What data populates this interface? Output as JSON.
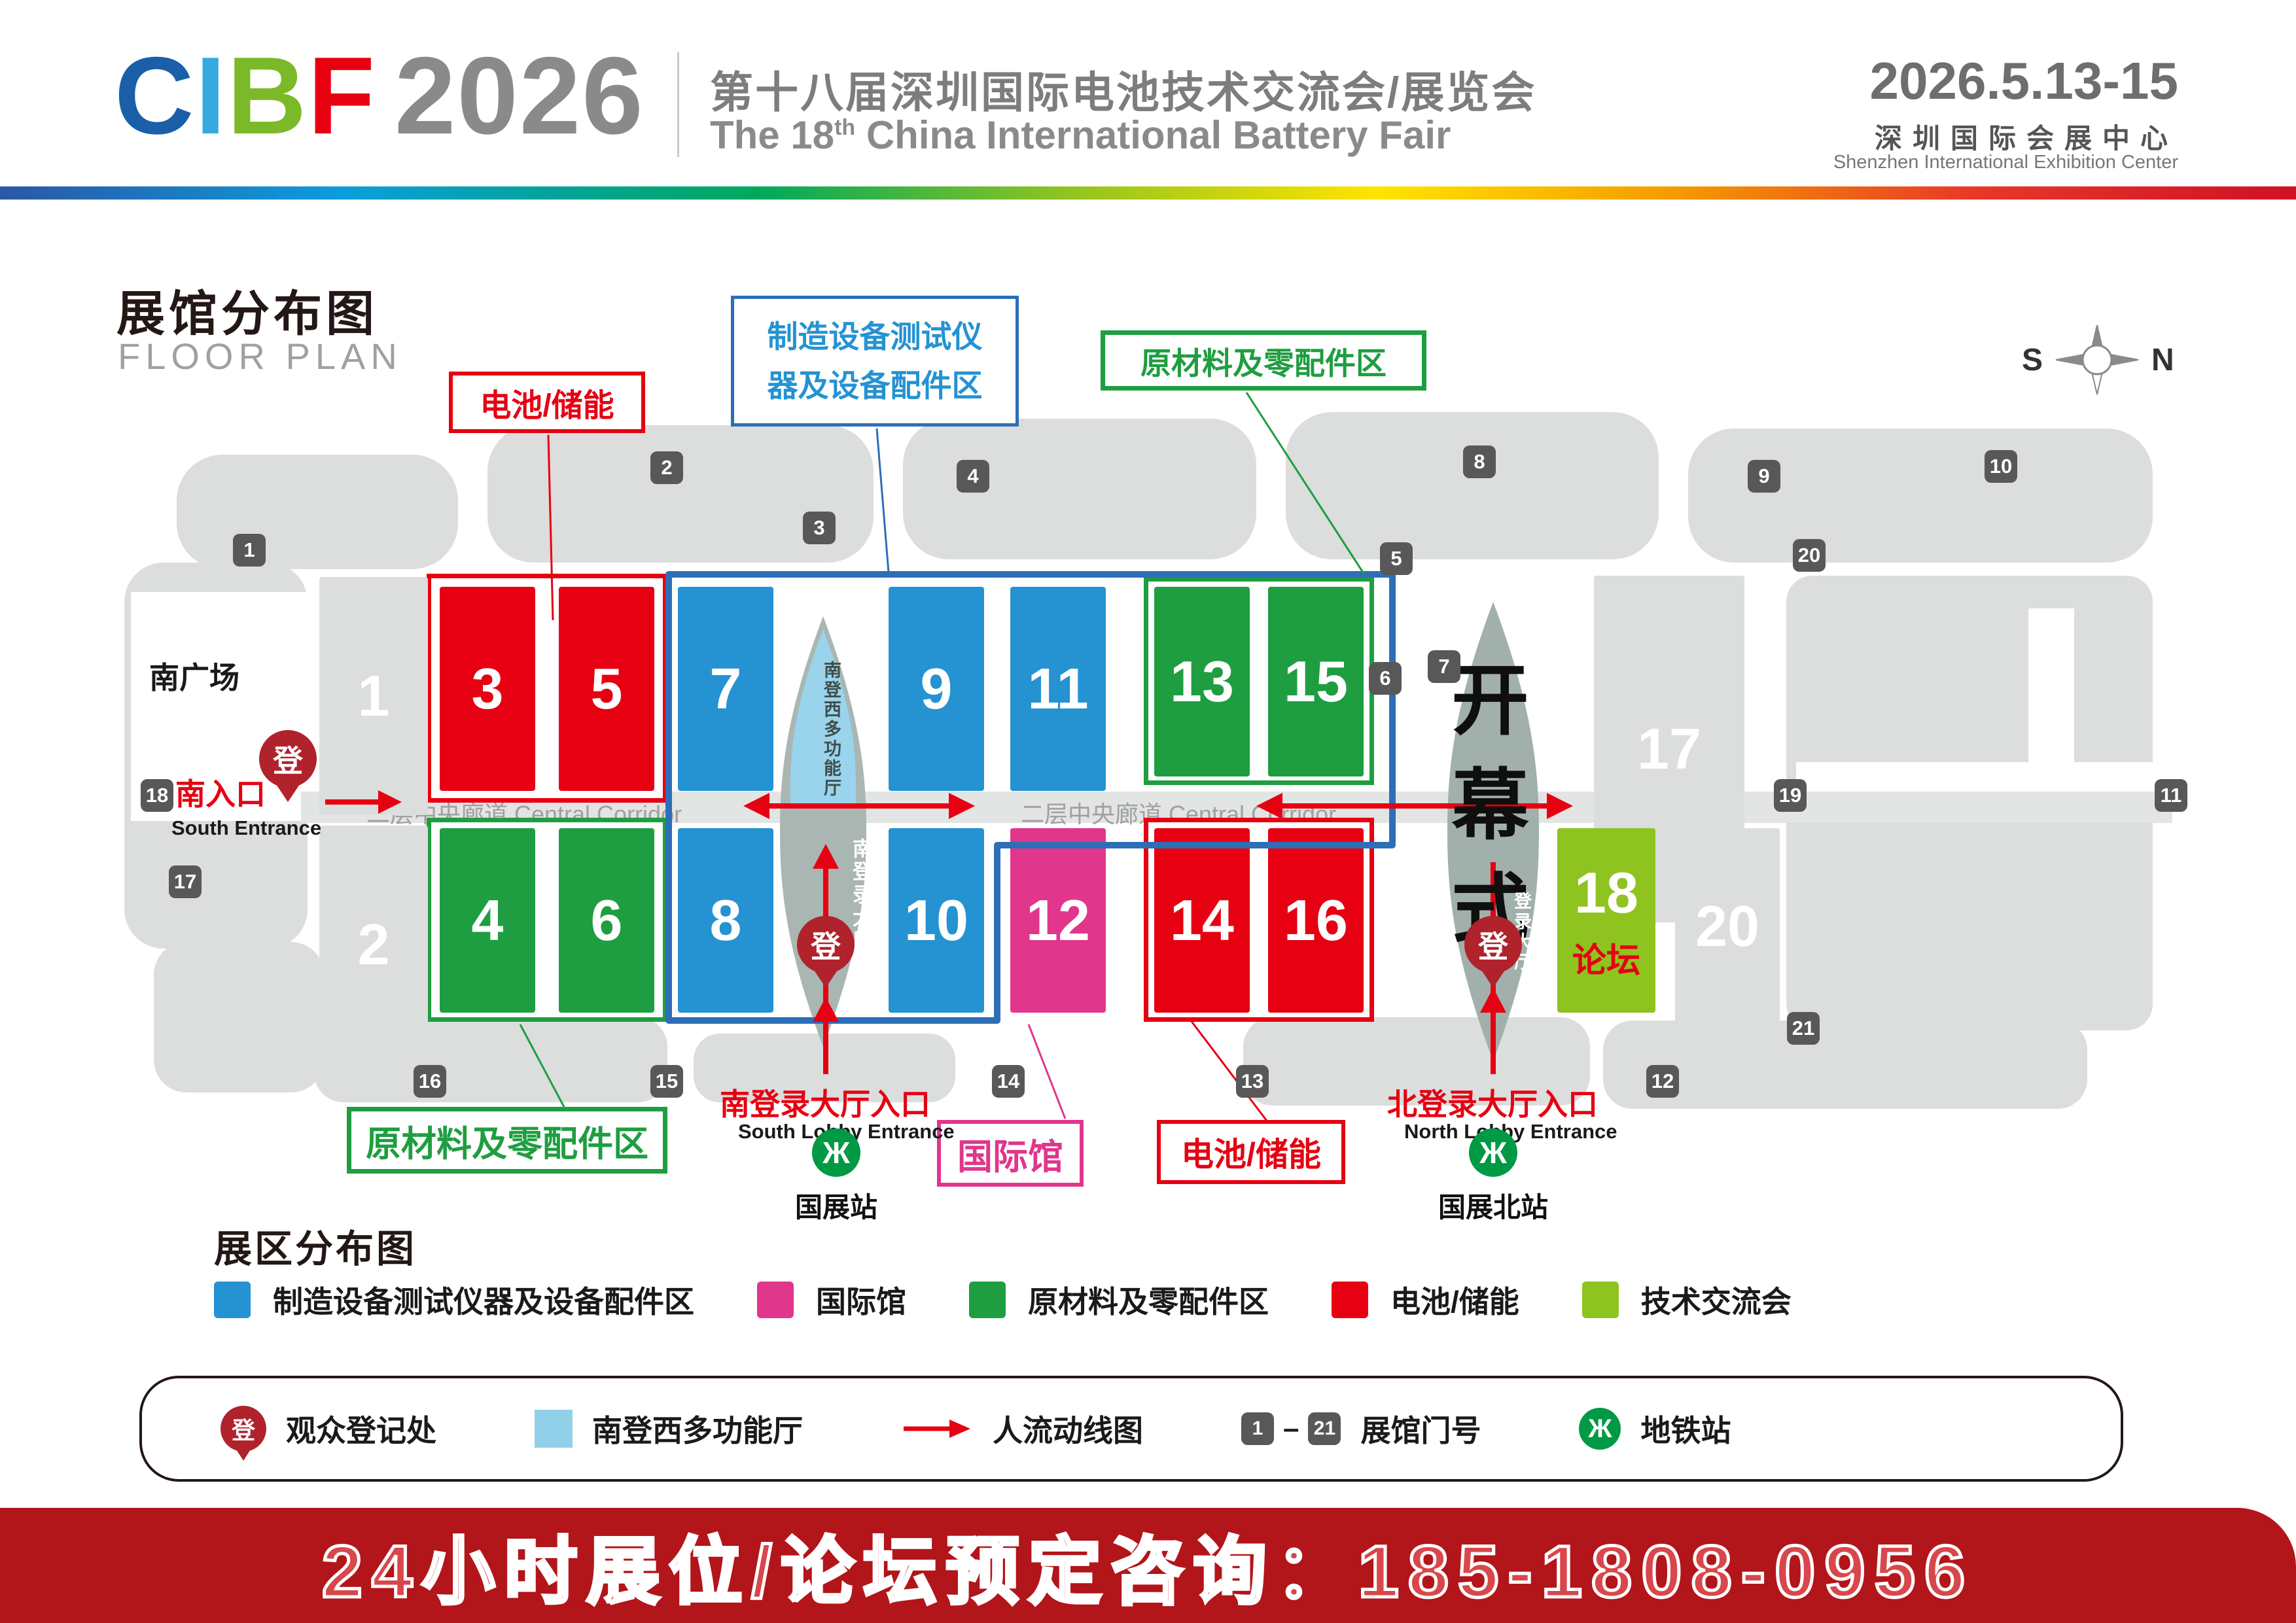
{
  "colors": {
    "red": "#e60012",
    "blue": "#2592d2",
    "blueBorder": "#2d6fb7",
    "green": "#1e9e40",
    "magenta": "#e0368c",
    "lime": "#8fc31f",
    "lightblue": "#92cfe8",
    "sage": "#a9b6b2",
    "sage2": "#a2b0ab",
    "gray": "#dcdddd",
    "badge": "#595757",
    "pin": "#b0222c",
    "metro": "#009944",
    "footer": "#b2151a"
  },
  "header": {
    "logo": {
      "c": "C",
      "i": "I",
      "b": "B",
      "f": "F",
      "year": "2026"
    },
    "title_cn": "第十八届深圳国际电池技术交流会/展览会",
    "title_en_prefix": "The 18",
    "title_en_sup": "th",
    "title_en_suffix": " China International Battery Fair",
    "date": "2026.5.13-15",
    "venue_cn": "深圳国际会展中心",
    "venue_en": "Shenzhen International Exhibition Center"
  },
  "plan": {
    "title_cn": "展馆分布图",
    "title_en": "FLOOR PLAN",
    "compass": {
      "south": "S",
      "north": "N"
    },
    "corridor_label": "二层中央廊道 Central Corridor",
    "south_plaza": "南广场",
    "callouts": {
      "battery_top": "电池/储能",
      "equipment_line1": "制造设备测试仪",
      "equipment_line2": "器及设备配件区",
      "materials_top": "原材料及零配件区",
      "materials_bottom": "原材料及零配件区",
      "international": "国际馆",
      "battery_bottom": "电池/储能"
    },
    "areas": {
      "opening_ceremony": "开幕式",
      "south_multi_hall": "南登西多功能厅",
      "south_lobby_hall": "南登录大厅",
      "north_lobby_hall": "登录大厅",
      "reg_pin": "登"
    },
    "entrances": {
      "south_cn": "南入口",
      "south_en": "South Entrance",
      "south_lobby_cn": "南登录大厅入口",
      "south_lobby_en": "South Lobby Entrance",
      "north_lobby_cn": "北登录大厅入口",
      "north_lobby_en": "North Lobby Entrance"
    },
    "metro": {
      "south": "国展站",
      "north": "国展北站"
    },
    "halls": {
      "h1": "1",
      "h2": "2",
      "h3": "3",
      "h4": "4",
      "h5": "5",
      "h6": "6",
      "h7": "7",
      "h8": "8",
      "h9": "9",
      "h10": "10",
      "h11": "11",
      "h12": "12",
      "h13": "13",
      "h14": "14",
      "h15": "15",
      "h16": "16",
      "h17": "17",
      "h18": "18",
      "h18_sub": "论坛",
      "h20": "20"
    },
    "gates": {
      "g1": "1",
      "g2": "2",
      "g3": "3",
      "g4": "4",
      "g5": "5",
      "g6": "6",
      "g7": "7",
      "g8": "8",
      "g9": "9",
      "g10": "10",
      "g11": "11",
      "g12": "12",
      "g13": "13",
      "g14": "14",
      "g15": "15",
      "g16": "16",
      "g17": "17",
      "g18": "18",
      "g19": "19",
      "g20": "20",
      "g21": "21"
    }
  },
  "legend": {
    "title": "展区分布图",
    "items": [
      {
        "id": "equipment",
        "label": "制造设备测试仪器及设备配件区",
        "color": "#2592d2"
      },
      {
        "id": "international",
        "label": "国际馆",
        "color": "#e0368c"
      },
      {
        "id": "materials",
        "label": "原材料及零配件区",
        "color": "#1e9e40"
      },
      {
        "id": "battery",
        "label": "电池/储能",
        "color": "#e60012"
      },
      {
        "id": "forum",
        "label": "技术交流会",
        "color": "#8fc31f"
      }
    ]
  },
  "key_bar": {
    "registration": "观众登记处",
    "multi_hall": "南登西多功能厅",
    "flow": "人流动线图",
    "gate_from": "1",
    "gate_dash": "–",
    "gate_to": "21",
    "gate_label": "展馆门号",
    "metro": "地铁站",
    "metro_glyph": "Ж",
    "pin_glyph": "登"
  },
  "footer": {
    "text": "24小时展位/论坛预定咨询：185-1808-0956"
  }
}
